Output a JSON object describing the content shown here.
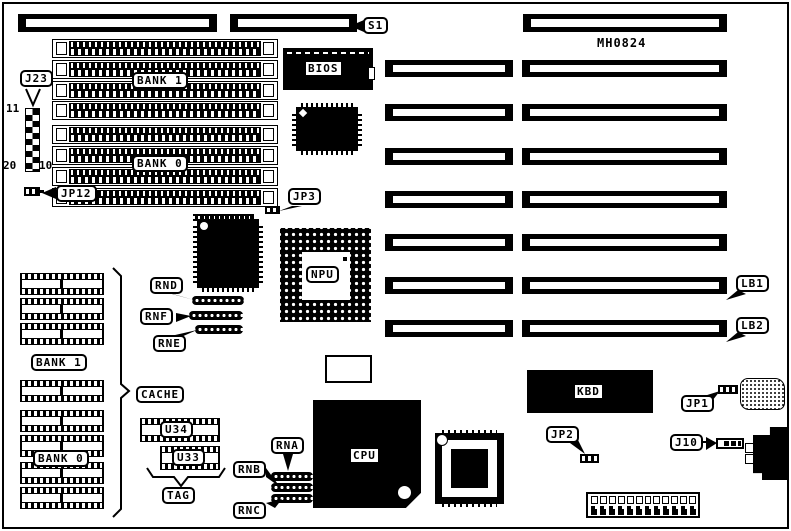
{
  "board": {
    "part_number": "MH0824"
  },
  "connectors": {
    "s1": "S1",
    "j23": "J23",
    "j10": "J10"
  },
  "jumpers": {
    "jp1": "JP1",
    "jp2": "JP2",
    "jp3": "JP3",
    "jp12": "JP12"
  },
  "slots": {
    "lb1": "LB1",
    "lb2": "LB2"
  },
  "memory": {
    "bank1": "BANK 1",
    "bank0": "BANK 0"
  },
  "cache": {
    "label": "CACHE",
    "bank1": "BANK 1",
    "bank0": "BANK 0",
    "tag": "TAG",
    "u34": "U34",
    "u33": "U33"
  },
  "chips": {
    "bios": "BIOS",
    "npu": "NPU",
    "cpu": "CPU",
    "kbd": "KBD"
  },
  "resistor_networks": {
    "rnd": "RND",
    "rnf": "RNF",
    "rne": "RNE",
    "rna": "RNA",
    "rnb": "RNB",
    "rnc": "RNC"
  },
  "pin_numbers": {
    "j23_pin11": "11",
    "j23_pin20": "20",
    "j23_pin10": "10"
  },
  "colors": {
    "ink": "#000000",
    "paper": "#ffffff"
  }
}
